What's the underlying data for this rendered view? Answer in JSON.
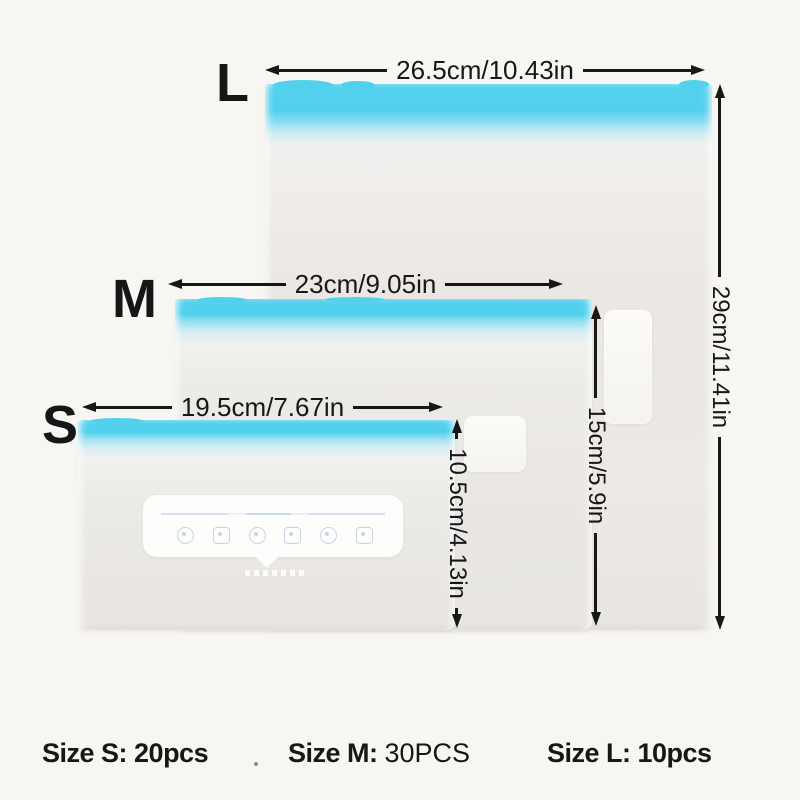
{
  "diagram": {
    "description_visible": false
  },
  "sizes": [
    {
      "label": "L",
      "width_label": "26.5cm/10.43in",
      "height_label": "29cm/11.41in"
    },
    {
      "label": "M",
      "width_label": "23cm/9.05in",
      "height_label": "15cm/5.9in"
    },
    {
      "label": "S",
      "width_label": "19.5cm/7.67in",
      "height_label": "10.5cm/4.13in"
    }
  ],
  "captions": [
    {
      "size_label": "Size S:",
      "count": "20pcs"
    },
    {
      "size_label": "Size M:",
      "count": "30PCS"
    },
    {
      "size_label": "Size L:",
      "count": "10pcs"
    }
  ],
  "colors": {
    "zipper_cyan": "#50d0ec",
    "bag_body": "#e9e6e3",
    "background": "#f8f6f2",
    "annotation": "#171717"
  }
}
